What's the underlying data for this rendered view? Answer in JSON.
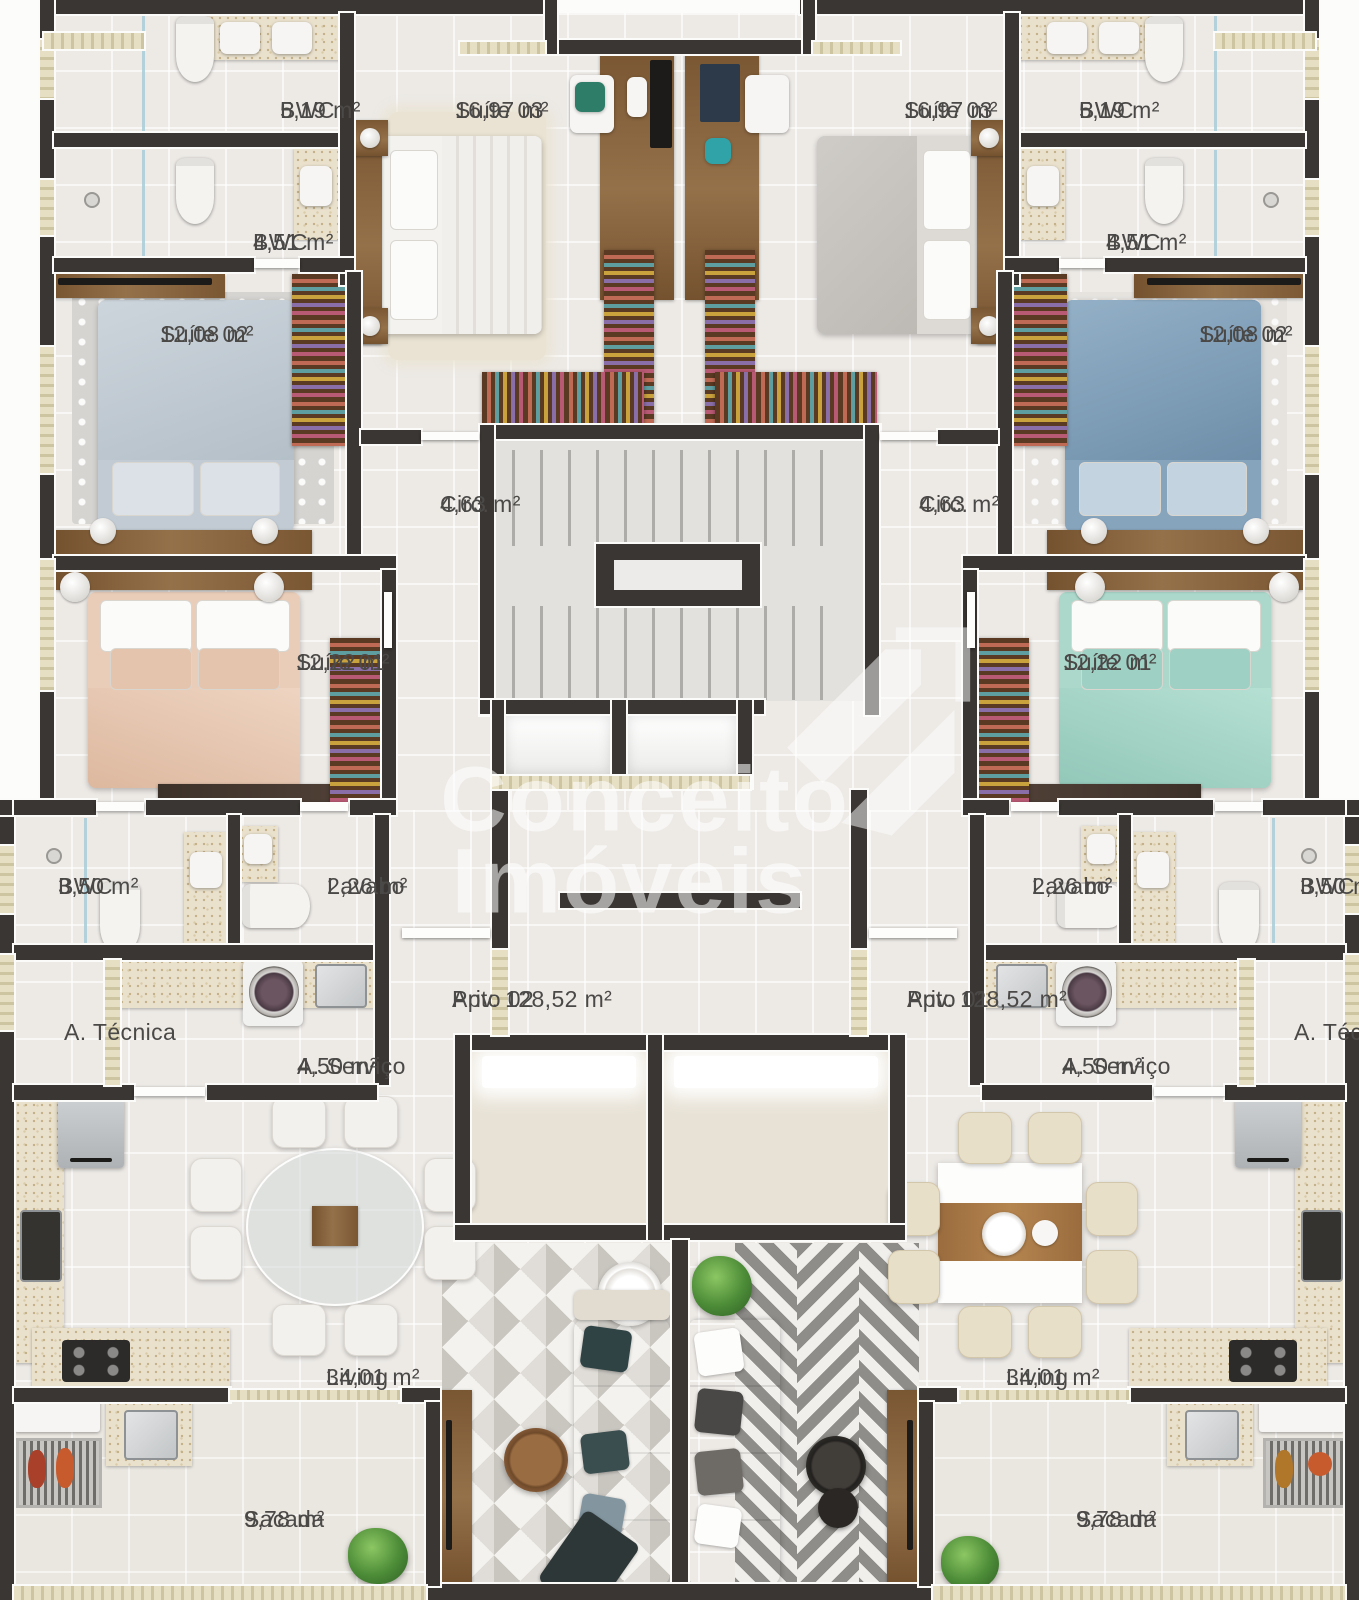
{
  "watermark": {
    "line1": "Conceito",
    "line2": "Imóveis",
    "logo": "conceito-arrow-logo"
  },
  "rooms": {
    "bwc519": {
      "title": "BWC",
      "area": "5,19 m²"
    },
    "suite03": {
      "title": "Suíte 03",
      "area": "16,97 m²"
    },
    "bwc451": {
      "title": "BWC",
      "area": "4,51 m²"
    },
    "suite02": {
      "title": "Suíte 02",
      "area": "12,08 m²"
    },
    "circ": {
      "title": "Circ.",
      "area": "4,63 m²"
    },
    "suite01": {
      "title": "Suíte 01",
      "area": "12,22 m²"
    },
    "bwc350": {
      "title": "BWC",
      "area": "3,50 m²"
    },
    "lavabo": {
      "title": "Lavabo",
      "area": "2,26 m²"
    },
    "atecnica": {
      "title": "A. Técnica"
    },
    "aservico": {
      "title": "A. Serviço",
      "area": "4,50 m²"
    },
    "apto02": {
      "title": "Apto 02",
      "area": "Priv. 128,52 m²"
    },
    "apto01": {
      "title": "Apto 01",
      "area": "Priv. 128,52 m²"
    },
    "living": {
      "title": "Living",
      "area": "34,01 m²"
    },
    "sacada": {
      "title": "Sacada",
      "area": "9,78 m²"
    }
  },
  "colors": {
    "wall": "#3a3633",
    "wall_outline": "#fbfbf9",
    "floor": "#edeae6",
    "counter": "#eae1cd",
    "wood": "#84603e",
    "label_text": "#4b4947",
    "watermark": "rgba(255,255,255,0.55)"
  }
}
